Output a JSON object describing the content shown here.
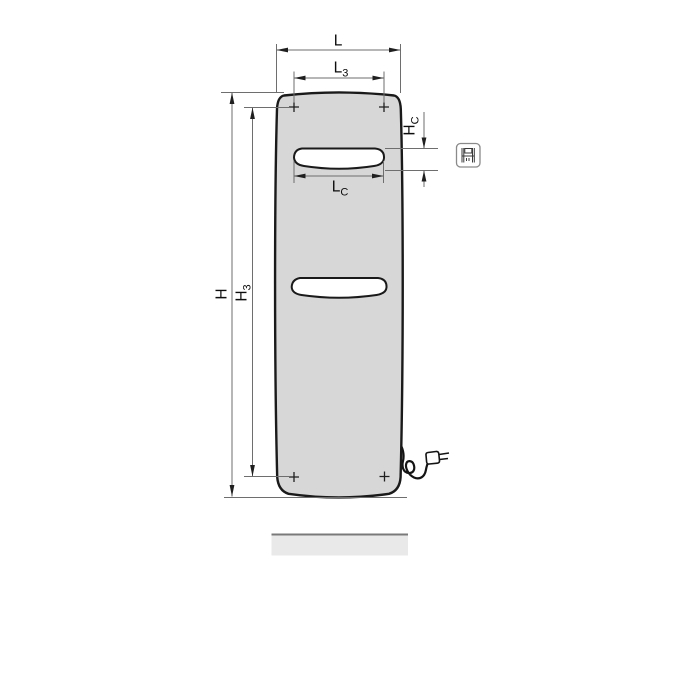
{
  "diagram": {
    "labels": {
      "width_overall": {
        "base": "L",
        "sub": ""
      },
      "width_fixing_points": {
        "base": "L",
        "sub": "3"
      },
      "height_overall": {
        "base": "H",
        "sub": ""
      },
      "height_fixing_points": {
        "base": "H",
        "sub": "3"
      },
      "cutout_height": {
        "base": "H",
        "sub": "C"
      },
      "cutout_width": {
        "base": "L",
        "sub": "C"
      }
    },
    "icons": {
      "margin_icon": "radiator-schematic-icon"
    },
    "colors": {
      "panel_fill": "#d7d7d7",
      "slot_fill": "#ffffff",
      "outline": "#1a1a1a",
      "dimension_line": "#6e6e6e",
      "floor_fill": "#e9e9e9",
      "floor_edge": "#7a7a7a"
    }
  }
}
